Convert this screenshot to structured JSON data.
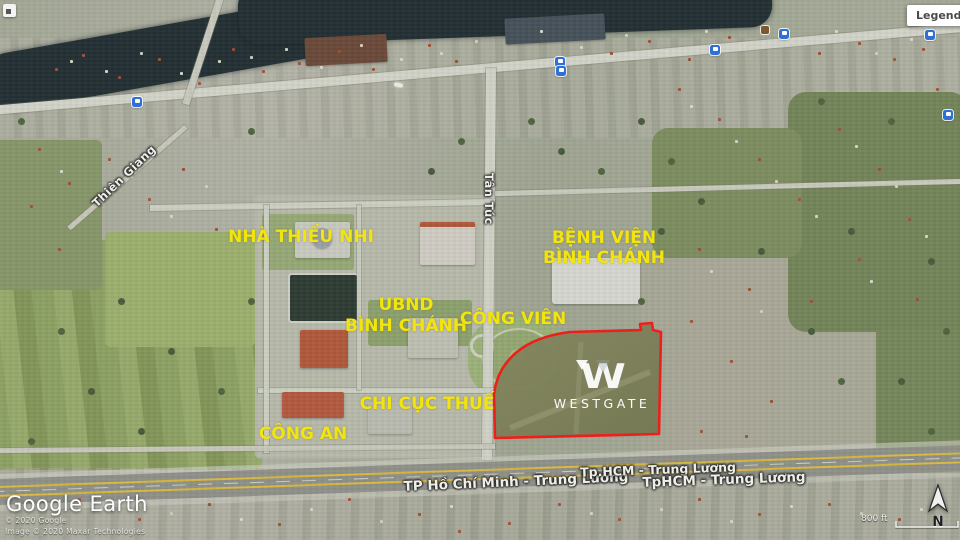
{
  "app": {
    "legend_button_label": "Legend",
    "watermark": "Google Earth",
    "copyright_line1": "© 2020 Google",
    "copyright_line2": "Image © 2020 Maxar Technologies",
    "scale_label": "800 ft",
    "north_indicator": "N"
  },
  "map": {
    "place_labels": {
      "nha_thieu_nhi": "NHÀ THIẾU NHI",
      "benh_vien_line1": "BỆNH VIỆN",
      "benh_vien_line2": "BÌNH CHÁNH",
      "ubnd_line1": "UBND",
      "ubnd_line2": "BÌNH CHÁNH",
      "cong_vien": "CÔNG VIÊN",
      "chi_cuc_thue": "CHI CỤC THUẾ",
      "cong_an": "CÔNG AN"
    },
    "street_labels": {
      "thien_giang": "Thiên Giang",
      "tan_tuc": "Tân Túc",
      "highway_left": "TP Hồ Chí Minh - Trung Lương",
      "highway_mid": "Tp.HCM - Trung Lương",
      "highway_right": "TpHCM - Trung Lương"
    },
    "project_overlay": {
      "monogram": "W",
      "wordmark": "WESTGATE"
    },
    "colors": {
      "place_label_yellow": "#f2e40e",
      "boundary_red": "#ee1e1a",
      "road_label_white": "#efeee8"
    }
  }
}
